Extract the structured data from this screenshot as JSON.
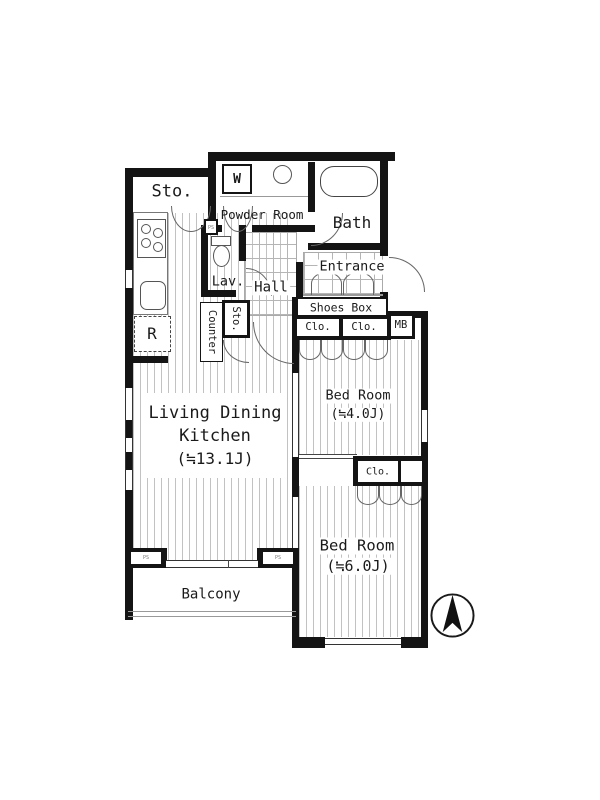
{
  "title": "apartment-floor-plan",
  "labels": {
    "sto_top": "Sto.",
    "washer": "W",
    "powder": "Powder Room",
    "bath": "Bath",
    "lav": "Lav.",
    "hall": "Hall",
    "entrance": "Entrance",
    "shoes_box": "Shoes Box",
    "clo_a": "Clo.",
    "clo_b": "Clo.",
    "mb": "MB",
    "counter": "Counter",
    "sto_small": "Sto.",
    "fridge": "R",
    "ldk_line1": "Living Dining",
    "ldk_line2": "Kitchen",
    "ldk_size": "(≒13.1J)",
    "bed1": "Bed Room",
    "bed1_size": "(≒4.0J)",
    "clo_c": "Clo.",
    "bed2": "Bed Room",
    "bed2_size": "(≒6.0J)",
    "balcony": "Balcony",
    "ps_left": "PS",
    "ps_right": "PS",
    "ps_top": "PS"
  },
  "colors": {
    "wall": "#141414",
    "door_line": "#666666",
    "floor_stripe": "#c2c2c2",
    "tile_line": "#b5b5b5"
  }
}
